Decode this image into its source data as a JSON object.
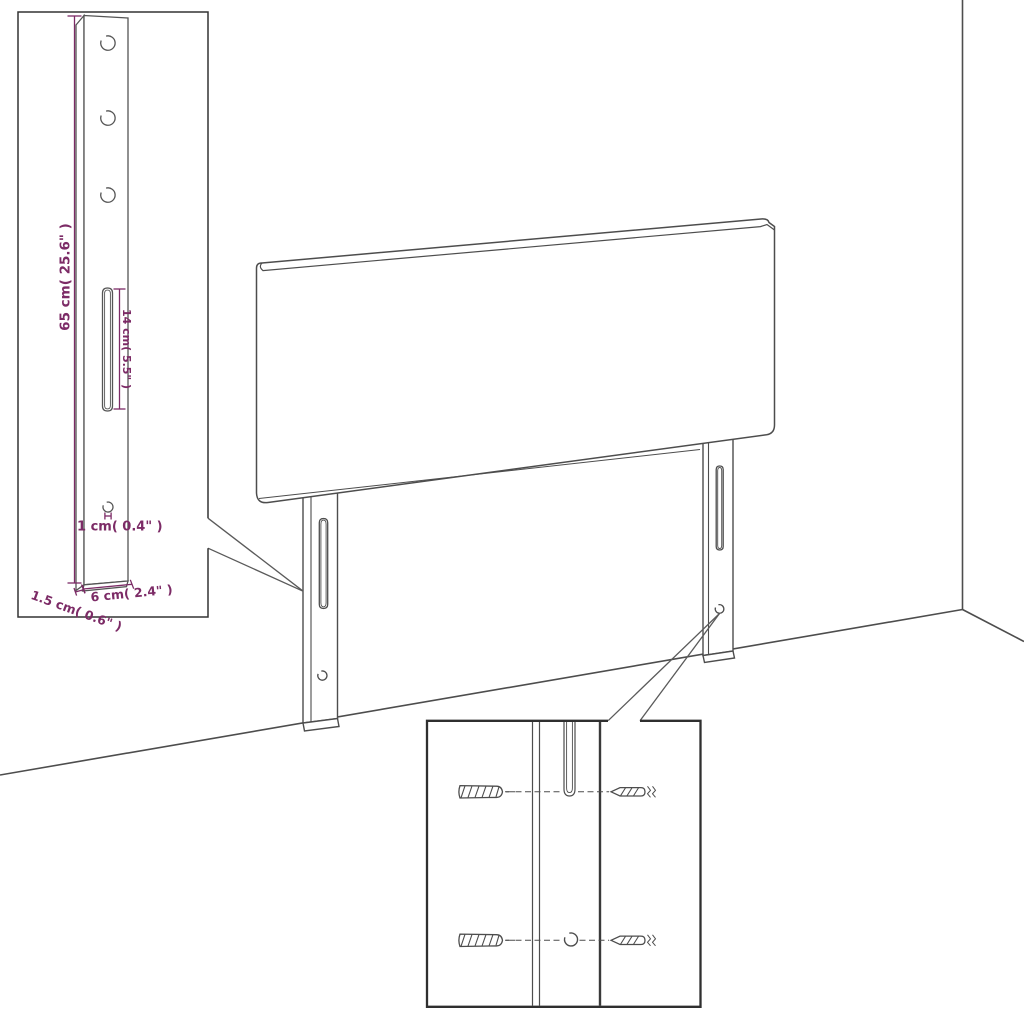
{
  "diagram": {
    "title": "headboard-assembly-diagram",
    "colors": {
      "line": "#4d4d4d",
      "dimension": "#7c2b66",
      "detail_box_border": "#2f2f2f",
      "background": "#ffffff"
    },
    "dimensions": {
      "leg_height": "65 cm( 25.6\" )",
      "slot_length": "14 cm( 5.5\" )",
      "hole_diameter": "1 cm( 0.4\" )",
      "leg_thickness": "1.5 cm( 0.6\" )",
      "leg_width": "6 cm( 2.4\" )"
    },
    "parts": {
      "headboard": "headboard-panel",
      "left_leg": "left-leg",
      "right_leg": "right-leg",
      "hardware": [
        "wall-plug",
        "screw"
      ]
    }
  }
}
